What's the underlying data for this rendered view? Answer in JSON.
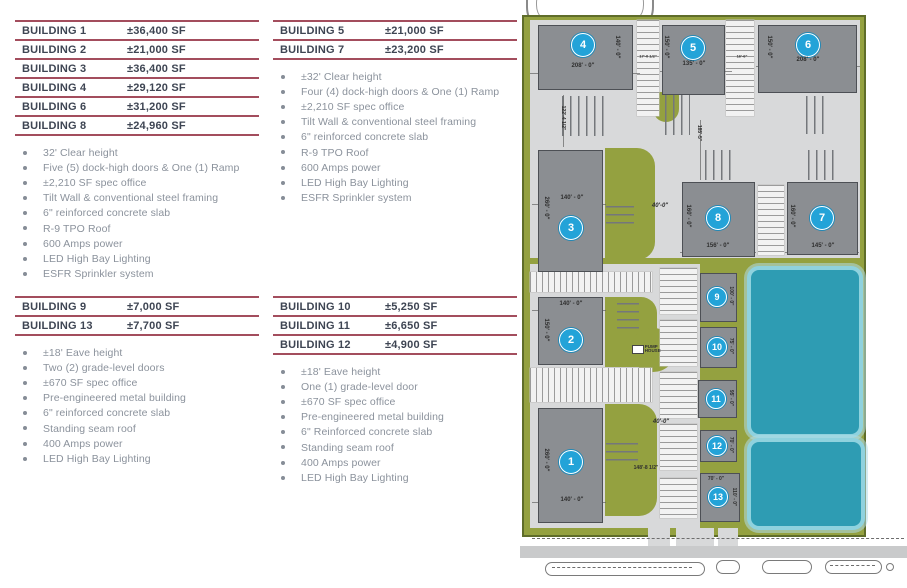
{
  "colors": {
    "accent_rule": "#a34d5d",
    "heading_text": "#3e4553",
    "bullet_text": "#8b929c",
    "site_green": "#94a140",
    "paving": "#d8d9da",
    "building_gray": "#8b8e92",
    "pond_teal": "#2e9cb3",
    "circle_blue": "#23a3d8"
  },
  "specs": {
    "groups": [
      {
        "table": [
          {
            "name": "BUILDING 1",
            "sf": "±36,400 SF"
          },
          {
            "name": "BUILDING 2",
            "sf": "±21,000 SF"
          },
          {
            "name": "BUILDING 3",
            "sf": "±36,400 SF"
          },
          {
            "name": "BUILDING 4",
            "sf": "±29,120 SF"
          },
          {
            "name": "BUILDING 6",
            "sf": "±31,200 SF"
          },
          {
            "name": "BUILDING 8",
            "sf": "±24,960 SF"
          }
        ],
        "bullets": [
          "32' Clear height",
          "Five (5) dock-high doors & One (1) Ramp",
          "±2,210 SF spec office",
          "Tilt Wall & conventional steel framing",
          "6\" reinforced concrete slab",
          "R-9 TPO Roof",
          "600 Amps power",
          "LED High Bay Lighting",
          "ESFR Sprinkler system"
        ]
      },
      {
        "table": [
          {
            "name": "BUILDING 5",
            "sf": "±21,000 SF"
          },
          {
            "name": "BUILDING 7",
            "sf": "±23,200 SF"
          }
        ],
        "bullets": [
          "±32' Clear height",
          "Four (4) dock-high doors & One (1) Ramp",
          "±2,210 SF spec office",
          "Tilt Wall & conventional steel framing",
          "6\" reinforced concrete slab",
          "R-9 TPO Roof",
          "600 Amps power",
          "LED High Bay Lighting",
          "ESFR Sprinkler system"
        ]
      },
      {
        "table": [
          {
            "name": "BUILDING 9",
            "sf": "±7,000 SF"
          },
          {
            "name": "BUILDING 13",
            "sf": "±7,700 SF"
          }
        ],
        "bullets": [
          "±18' Eave height",
          "Two (2) grade-level doors",
          "±670 SF spec office",
          "Pre-engineered metal building",
          "6\" reinforced concrete slab",
          "Standing seam roof",
          "400 Amps power",
          "LED High Bay Lighting"
        ]
      },
      {
        "table": [
          {
            "name": "BUILDING 10",
            "sf": "±5,250 SF"
          },
          {
            "name": "BUILDING 11",
            "sf": "±6,650 SF"
          },
          {
            "name": "BUILDING 12",
            "sf": "±4,900 SF"
          }
        ],
        "bullets": [
          "±18' Eave height",
          "One (1) grade-level door",
          "±670 SF spec office",
          "Pre-engineered metal building",
          "6\" Reinforced concrete slab",
          "Standing seam roof",
          "400 Amps power",
          "LED High Bay Lighting"
        ]
      }
    ]
  },
  "siteplan": {
    "pump_house": "PUMP HOUSE",
    "buildings": [
      {
        "n": "4",
        "x": 18,
        "y": 25,
        "w": 95,
        "h": 65,
        "cx": 63,
        "cy": 45
      },
      {
        "n": "5",
        "x": 142,
        "y": 25,
        "w": 63,
        "h": 70,
        "cx": 173,
        "cy": 48
      },
      {
        "n": "6",
        "x": 238,
        "y": 25,
        "w": 99,
        "h": 68,
        "cx": 288,
        "cy": 45
      },
      {
        "n": "3",
        "x": 18,
        "y": 150,
        "w": 65,
        "h": 122,
        "cx": 51,
        "cy": 228
      },
      {
        "n": "8",
        "x": 162,
        "y": 182,
        "w": 73,
        "h": 75,
        "cx": 198,
        "cy": 218
      },
      {
        "n": "7",
        "x": 267,
        "y": 182,
        "w": 71,
        "h": 73,
        "cx": 302,
        "cy": 218
      },
      {
        "n": "2",
        "x": 18,
        "y": 297,
        "w": 65,
        "h": 68,
        "cx": 51,
        "cy": 340
      },
      {
        "n": "1",
        "x": 18,
        "y": 408,
        "w": 65,
        "h": 115,
        "cx": 51,
        "cy": 462
      },
      {
        "n": "9",
        "x": 180,
        "y": 273,
        "w": 37,
        "h": 49,
        "cx": 197,
        "cy": 297,
        "small": 1
      },
      {
        "n": "10",
        "x": 180,
        "y": 327,
        "w": 37,
        "h": 41,
        "cx": 197,
        "cy": 347,
        "small": 1
      },
      {
        "n": "11",
        "x": 178,
        "y": 380,
        "w": 39,
        "h": 38,
        "cx": 196,
        "cy": 399,
        "small": 1
      },
      {
        "n": "12",
        "x": 180,
        "y": 430,
        "w": 37,
        "h": 32,
        "cx": 197,
        "cy": 446,
        "small": 1
      },
      {
        "n": "13",
        "x": 180,
        "y": 473,
        "w": 40,
        "h": 49,
        "cx": 198,
        "cy": 497,
        "small": 1
      }
    ],
    "labels": [
      {
        "t": "208' - 0\"",
        "x": 63,
        "y": 66,
        "r": 0
      },
      {
        "t": "140' - 0\"",
        "x": 97,
        "y": 47,
        "r": 90
      },
      {
        "t": "135' - 0\"",
        "x": 174,
        "y": 64,
        "r": 0
      },
      {
        "t": "150' - 0\"",
        "x": 146,
        "y": 47,
        "r": 90
      },
      {
        "t": "208' - 0\"",
        "x": 288,
        "y": 60,
        "r": 0
      },
      {
        "t": "150' - 0\"",
        "x": 249,
        "y": 47,
        "r": 90
      },
      {
        "t": "17'-0 1/2\"",
        "x": 128,
        "y": 56,
        "r": 0,
        "s": 4
      },
      {
        "t": "16'-6\"",
        "x": 222,
        "y": 56,
        "r": 0,
        "s": 4
      },
      {
        "t": "122'-4 1/2\"",
        "x": 43,
        "y": 118,
        "r": 90,
        "s": 5
      },
      {
        "t": "185'-5\"",
        "x": 179,
        "y": 133,
        "r": 90,
        "s": 5
      },
      {
        "t": "260' - 0\"",
        "x": 26,
        "y": 208,
        "r": 90
      },
      {
        "t": "140' - 0\"",
        "x": 52,
        "y": 198,
        "r": 0
      },
      {
        "t": "40'-0\"",
        "x": 140,
        "y": 206,
        "r": 0,
        "i": 1
      },
      {
        "t": "160' - 0\"",
        "x": 168,
        "y": 216,
        "r": 90
      },
      {
        "t": "156' - 0\"",
        "x": 198,
        "y": 246,
        "r": 0
      },
      {
        "t": "160' - 0\"",
        "x": 272,
        "y": 216,
        "r": 90
      },
      {
        "t": "145' - 0\"",
        "x": 303,
        "y": 246,
        "r": 0
      },
      {
        "t": "140' - 0\"",
        "x": 51,
        "y": 304,
        "r": 0
      },
      {
        "t": "150' - 0\"",
        "x": 26,
        "y": 330,
        "r": 90
      },
      {
        "t": "100' - 0\"",
        "x": 211,
        "y": 296,
        "r": 90,
        "s": 5
      },
      {
        "t": "75' - 0\"",
        "x": 211,
        "y": 346,
        "r": 90,
        "s": 5
      },
      {
        "t": "95' - 0\"",
        "x": 211,
        "y": 398,
        "r": 90,
        "s": 5
      },
      {
        "t": "40'-0\"",
        "x": 141,
        "y": 422,
        "r": 0,
        "i": 1
      },
      {
        "t": "148'-8 1/2\"",
        "x": 126,
        "y": 468,
        "r": 0,
        "s": 5
      },
      {
        "t": "70' - 0\"",
        "x": 211,
        "y": 445,
        "r": 90,
        "s": 5
      },
      {
        "t": "260' - 0\"",
        "x": 26,
        "y": 460,
        "r": 90
      },
      {
        "t": "140' - 0\"",
        "x": 52,
        "y": 500,
        "r": 0
      },
      {
        "t": "70' - 0\"",
        "x": 196,
        "y": 479,
        "r": 0,
        "s": 5
      },
      {
        "t": "110' - 0\"",
        "x": 214,
        "y": 497,
        "r": 90,
        "s": 5
      }
    ]
  }
}
